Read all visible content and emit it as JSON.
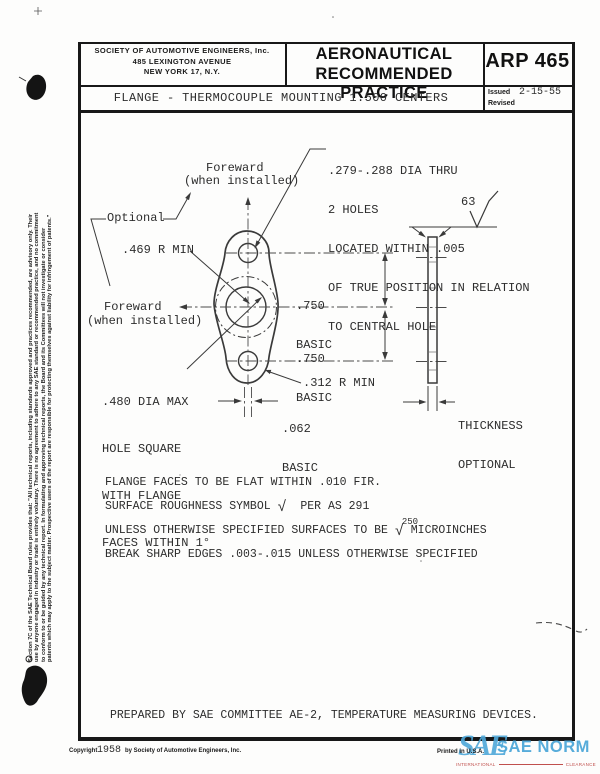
{
  "header": {
    "org_line1": "SOCIETY OF AUTOMOTIVE ENGINEERS, Inc.",
    "org_line2": "485 LEXINGTON AVENUE",
    "org_line3": "NEW YORK 17, N.Y.",
    "doc_type_line1": "AERONAUTICAL",
    "doc_type_line2": "RECOMMENDED PRACTICE",
    "doc_number": "ARP 465",
    "issued_label": "Issued",
    "issued_date": "2-15-55",
    "revised_label": "Revised",
    "title": "FLANGE - THERMOCOUPLE MOUNTING 1.500 CENTERS"
  },
  "drawing": {
    "callouts": {
      "holes_note_lines": [
        ".279-.288 DIA THRU",
        "2 HOLES",
        "LOCATED WITHIN .005",
        "OF TRUE POSITION IN RELATION",
        "TO CENTRAL HOLE"
      ],
      "foreward_top_line1": "Foreward",
      "foreward_top_line2": "(when installed)",
      "optional": "Optional",
      "radius_469": ".469 R MIN",
      "foreward_left_line1": "Foreward",
      "foreward_left_line2": "(when installed)",
      "center_hole_lines": [
        ".480 DIA MAX",
        "HOLE SQUARE",
        "WITH FLANGE",
        "FACES WITHIN 1°"
      ],
      "dim_750_top_line1": ".750",
      "dim_750_top_line2": "BASIC",
      "dim_750_bottom_line1": ".750",
      "dim_750_bottom_line2": "BASIC",
      "radius_312": ".312 R MIN",
      "dim_062_line1": ".062",
      "dim_062_line2": "BASIC",
      "surface_finish_value": "63",
      "thickness_line1": "THICKNESS",
      "thickness_line2": "OPTIONAL"
    },
    "notes": {
      "note1": "FLANGE FACES TO BE FLAT WITHIN .010 FIR.",
      "note2_pre": "SURFACE ROUGHNESS SYMBOL ",
      "note2_symbol": "√",
      "note2_post": "  PER AS 291",
      "note3_pre": "UNLESS OTHERWISE SPECIFIED SURFACES TO BE ",
      "note3_value": "250",
      "note3_symbol": "√",
      "note3_post": " MICROINCHES",
      "note4": "BREAK SHARP EDGES .003-.015 UNLESS OTHERWISE SPECIFIED"
    },
    "prepared_by": "PREPARED BY SAE COMMITTEE AE-2, TEMPERATURE MEASURING DEVICES."
  },
  "sidebar_disclaimer": {
    "lines": [
      "Section 7C of the SAE Technical Board rules provides that: \"All technical reports, including standards approved and practices recommended, are advisory only. Their",
      "use by anyone engaged in industry or trade is entirely voluntary. There is no agreement to adhere to any SAE standard or recommended practice, and no commitment",
      "to conform to or be guided by any technical report. In formulating and approving technical reports, the Board and its Committees will not investigate or consider",
      "patents which may apply to the subject matter. Prospective users of the report are responsible for protecting themselves against liability for infringement of patents.\""
    ]
  },
  "footer": {
    "copyright_label": "Copyright",
    "copyright_year": "1958",
    "copyright_rest": "by Society of Automotive Engineers, Inc.",
    "printed": "Printed in U.S.A."
  },
  "watermark": {
    "logo": "SAE",
    "text": "SAE NORM",
    "sub_left": "INTERNATIONAL",
    "sub_right": "CLEARANCE",
    "color": "#4fa8d9",
    "sub_color": "#c0504d"
  }
}
